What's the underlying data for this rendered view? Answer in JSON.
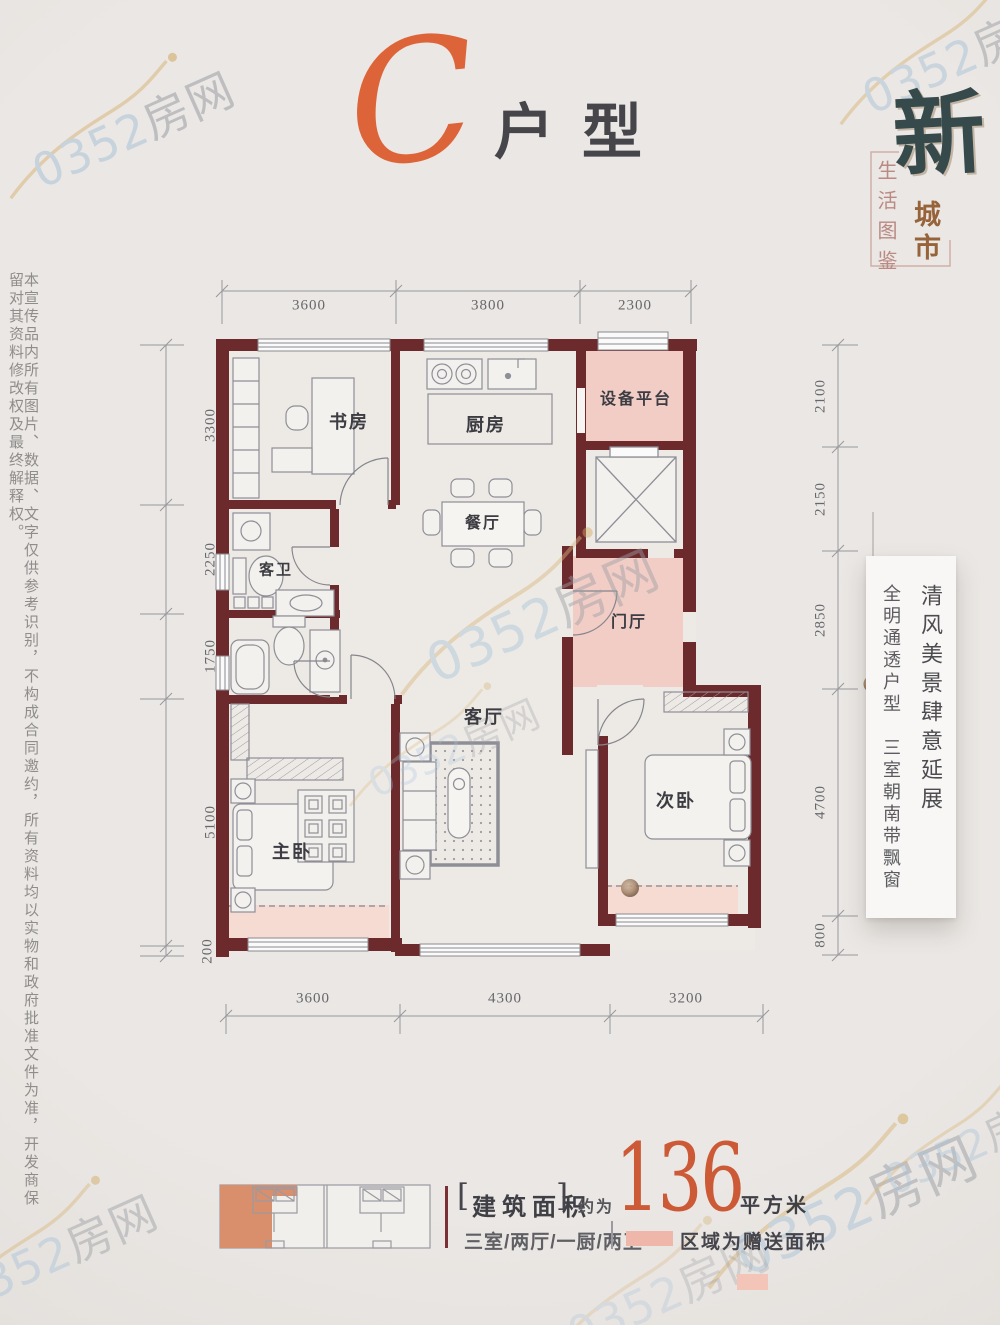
{
  "title": {
    "letter": "C",
    "suffix": "户型"
  },
  "brand": {
    "big": "新",
    "city": "城市",
    "tagline": "生活图鉴"
  },
  "left_disclaimer": "本宣传品内所有图片、数据、文字仅供参考识别，不构成合同邀约，所有资料均以实物和政府批准文件为准，开发商保留对其资料修改权及最终解释权。",
  "side_card": {
    "line1": "清风美景肆意延展",
    "line2": "全明通透户型　三室朝南带飘窗"
  },
  "plan": {
    "rooms": {
      "study": "书房",
      "kitchen": "厨房",
      "dining": "餐厅",
      "equipment": "设备平台",
      "foyer": "门厅",
      "guest_bath": "客卫",
      "living": "客厅",
      "master": "主卧",
      "second": "次卧"
    },
    "dims": {
      "top": [
        "3600",
        "3800",
        "2300"
      ],
      "bottom": [
        "3600",
        "4300",
        "3200"
      ],
      "left": [
        "3300",
        "2250",
        "1750",
        "5100",
        "200"
      ],
      "right": [
        "2100",
        "2150",
        "2850",
        "4700",
        "800"
      ]
    }
  },
  "footer": {
    "bracket_left": "[",
    "area_label": "建筑面积",
    "bracket_right": "]",
    "approx": "约为",
    "area_value": "136",
    "unit": "平方米",
    "layout": "三室/两厅/一厨/两卫",
    "gift_note": "区域为赠送面积"
  },
  "watermark": {
    "num": "0352",
    "cn": "房网"
  }
}
